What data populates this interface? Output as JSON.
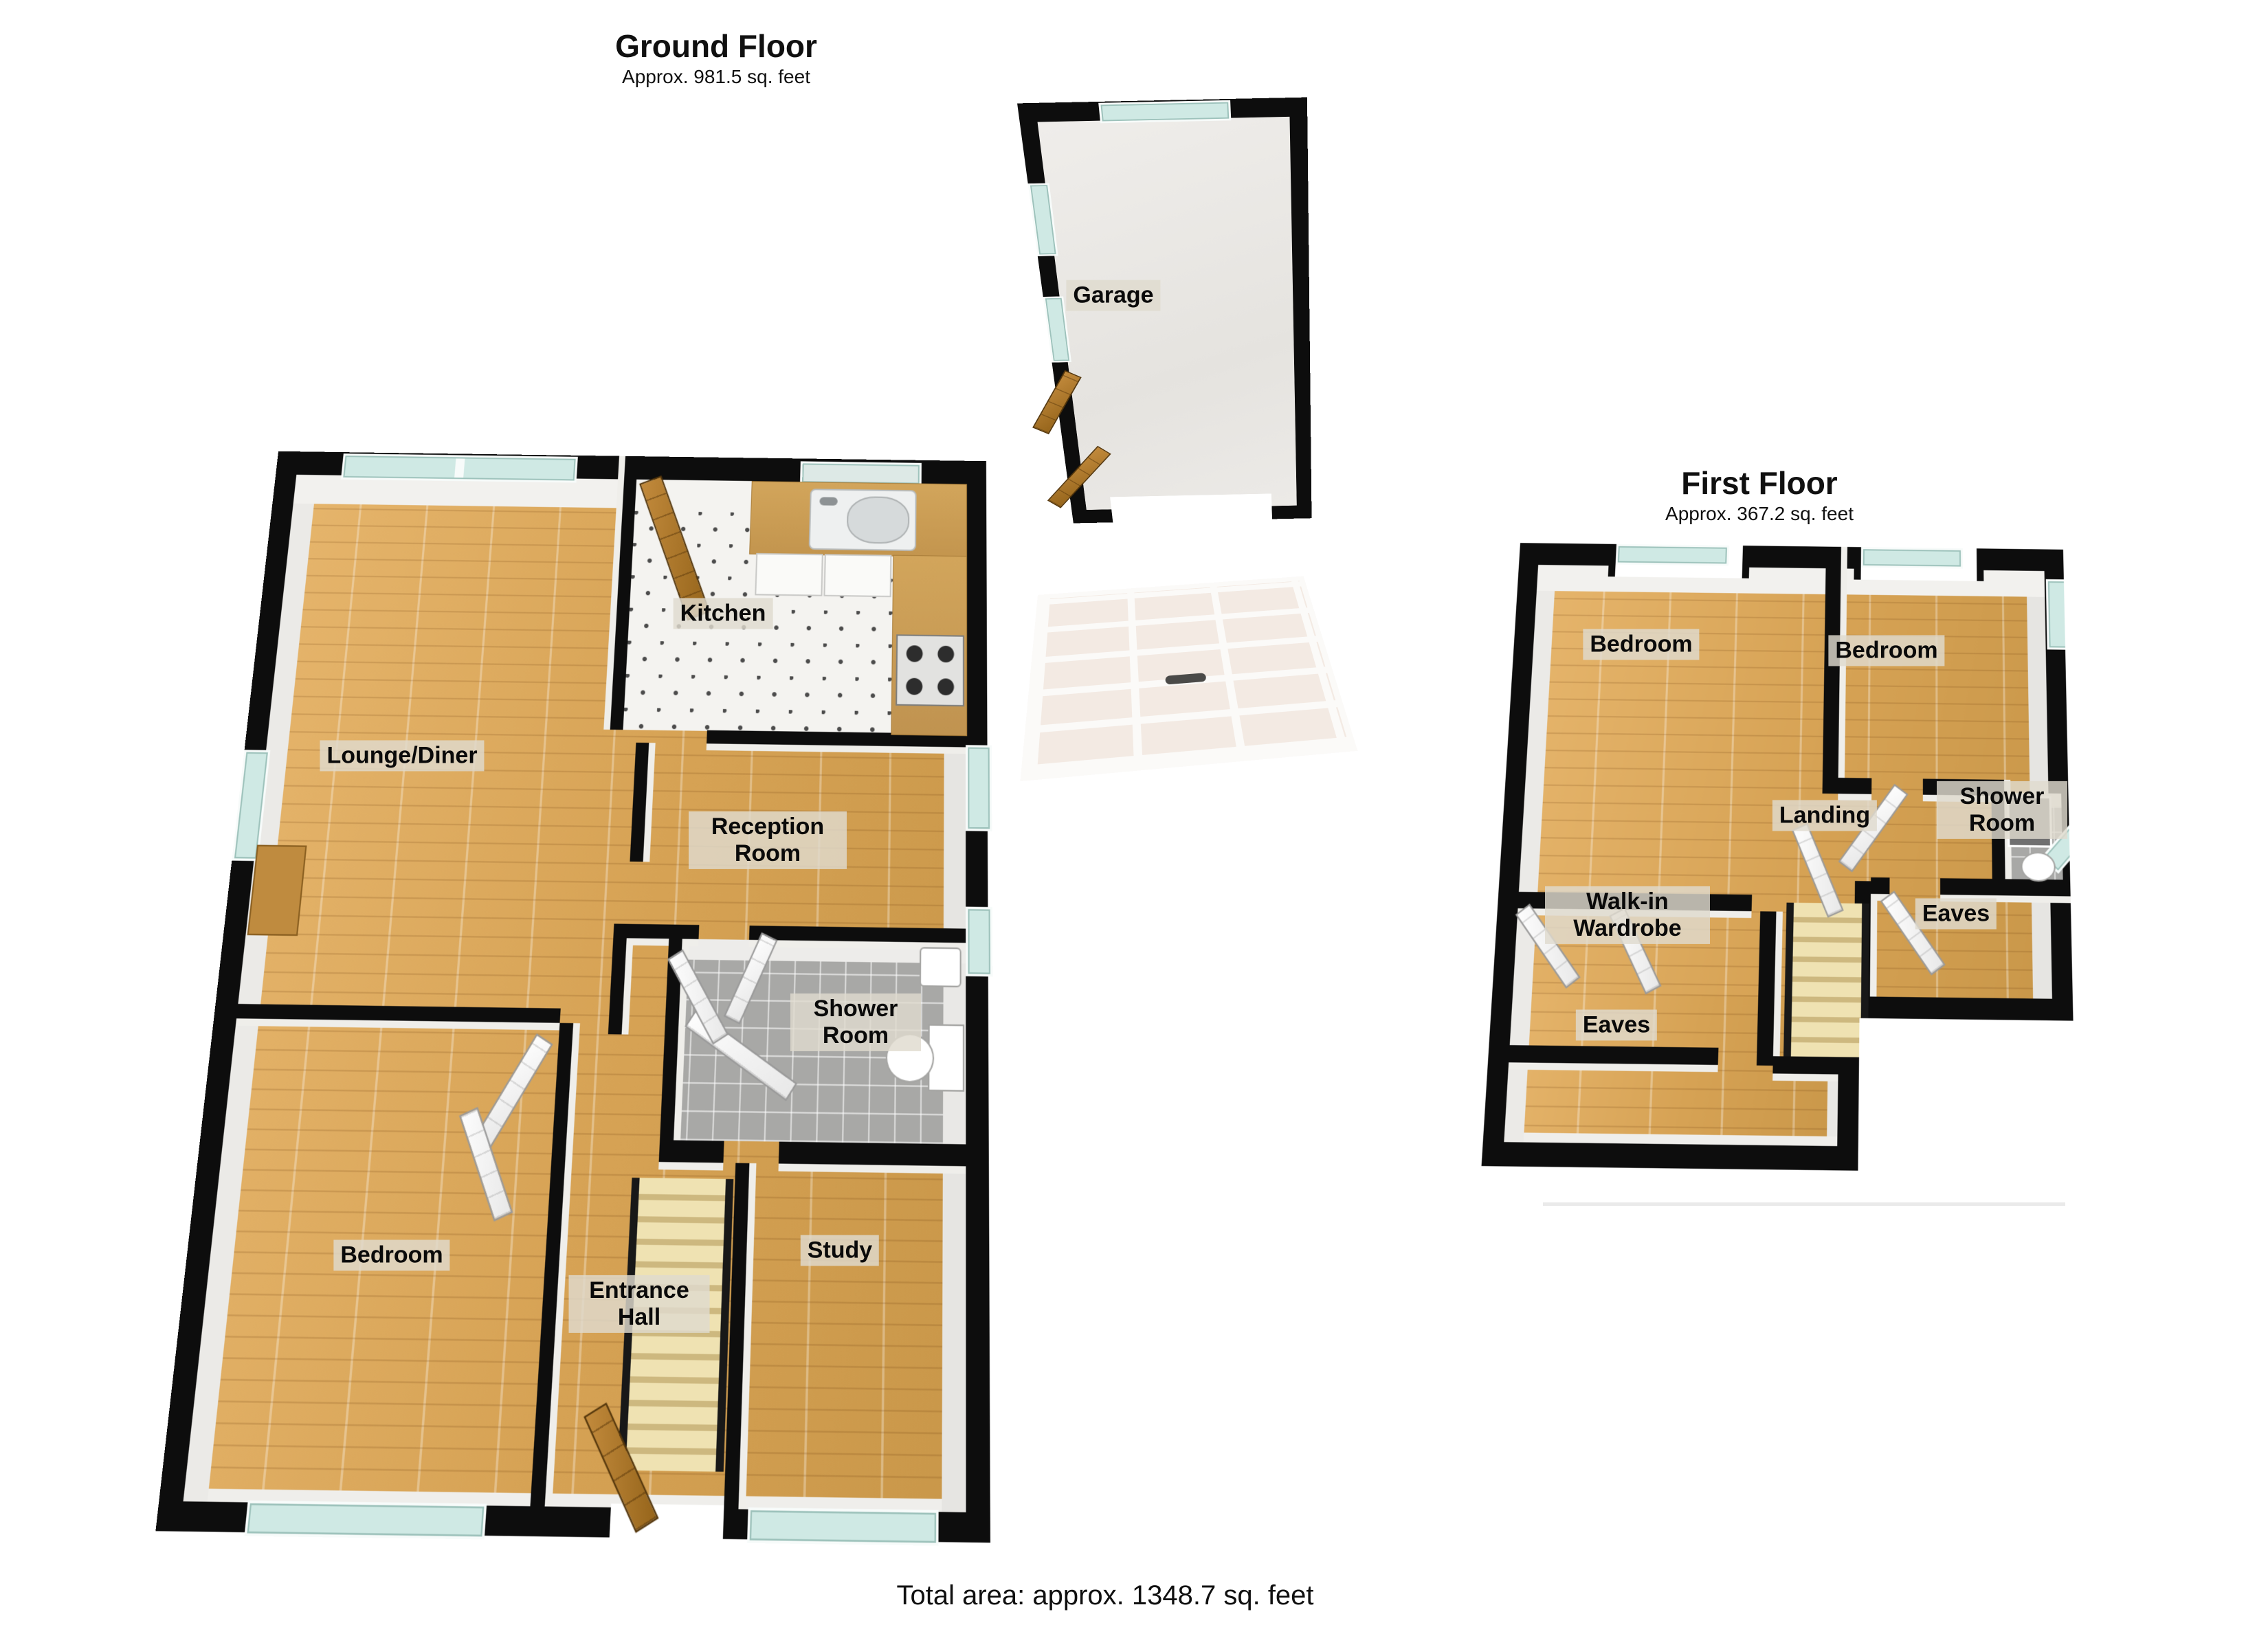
{
  "ground": {
    "title": "Ground Floor",
    "subtitle": "Approx. 981.5 sq. feet",
    "rooms": {
      "lounge": "Lounge/Diner",
      "kitchen": "Kitchen",
      "reception": "Reception Room",
      "shower": "Shower Room",
      "bedroom": "Bedroom",
      "entrance": "Entrance Hall",
      "study": "Study"
    }
  },
  "garage": {
    "label": "Garage"
  },
  "first": {
    "title": "First Floor",
    "subtitle": "Approx. 367.2 sq. feet",
    "rooms": {
      "bedroom_left": "Bedroom",
      "bedroom_right": "Bedroom",
      "shower": "Shower Room",
      "landing": "Landing",
      "wardrobe": "Walk-in Wardrobe",
      "eaves_right": "Eaves",
      "eaves_bottom": "Eaves"
    }
  },
  "footer": {
    "total_area": "Total area: approx. 1348.7 sq. feet"
  },
  "colors": {
    "wall": "#0d0d0d",
    "wood_floor": "#d9a75f",
    "kitchen_tile": "#f4f3f0",
    "shower_tile": "#a8a8a6",
    "window_glass": "#cfe9e4",
    "label_background": "#dfdace",
    "stairs": "#e6d5a0"
  }
}
